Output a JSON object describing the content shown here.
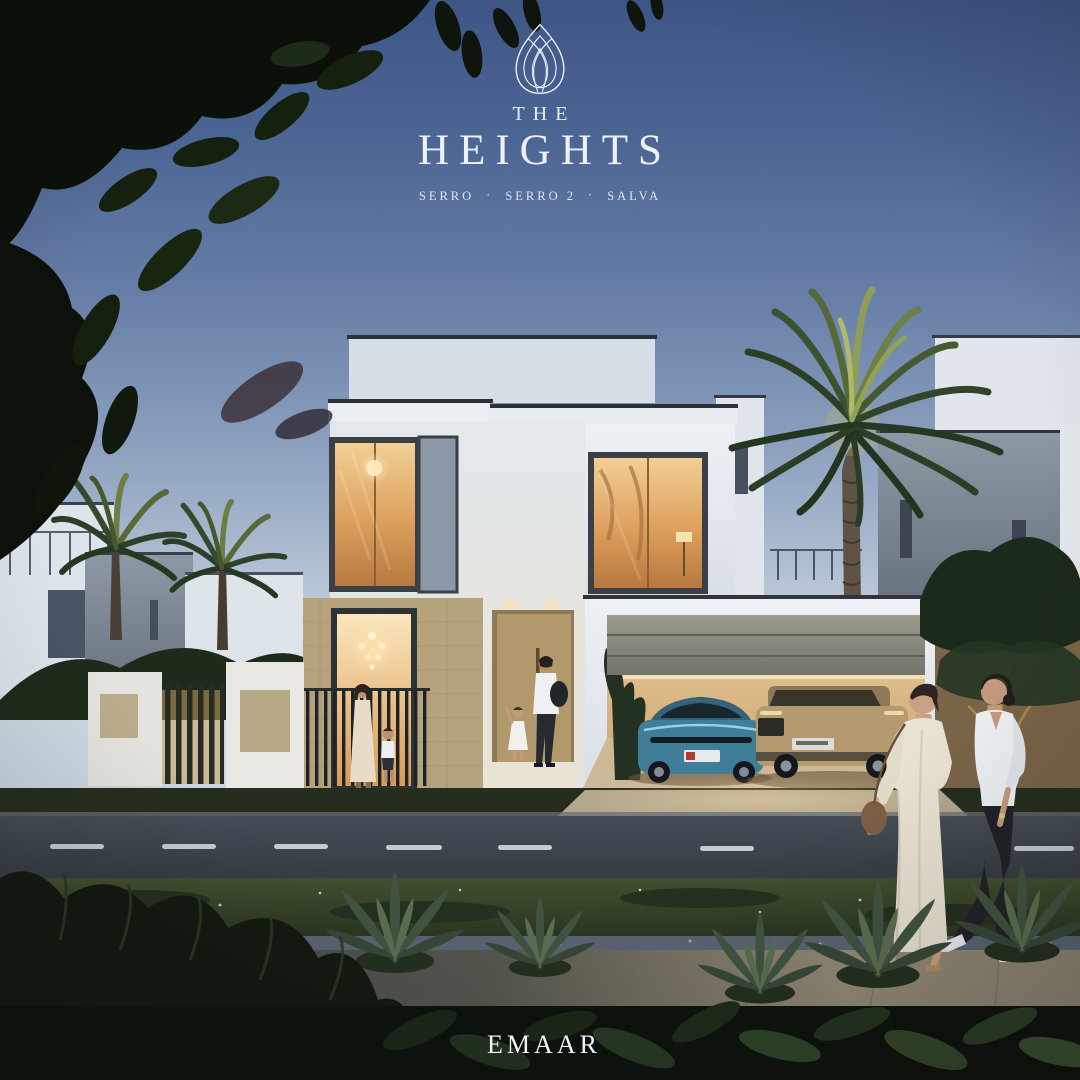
{
  "brand": {
    "pre_title": "THE",
    "title": "HEIGHTS",
    "separator": "·",
    "communities": [
      "SERRO",
      "SERRO 2",
      "SALVA"
    ],
    "developer": "EMAAR",
    "logo_color": "#eef2f8"
  },
  "palette": {
    "sky_top": "#3e5686",
    "sky_horizon": "#d0dae4",
    "villa_white": "#e7ecf1",
    "stone_beige": "#b6a37d",
    "door_tan": "#b1996c",
    "garage_door_olive": "#8d8e80",
    "window_glow": "#e2aa63",
    "car_teal": "#3f7d99",
    "car_beige": "#b59a70",
    "road_asphalt": "#3f454d",
    "lawn_green": "#3c4a31",
    "foliage_dark": "#0c120b",
    "palm_green": "#4c5f3a"
  }
}
